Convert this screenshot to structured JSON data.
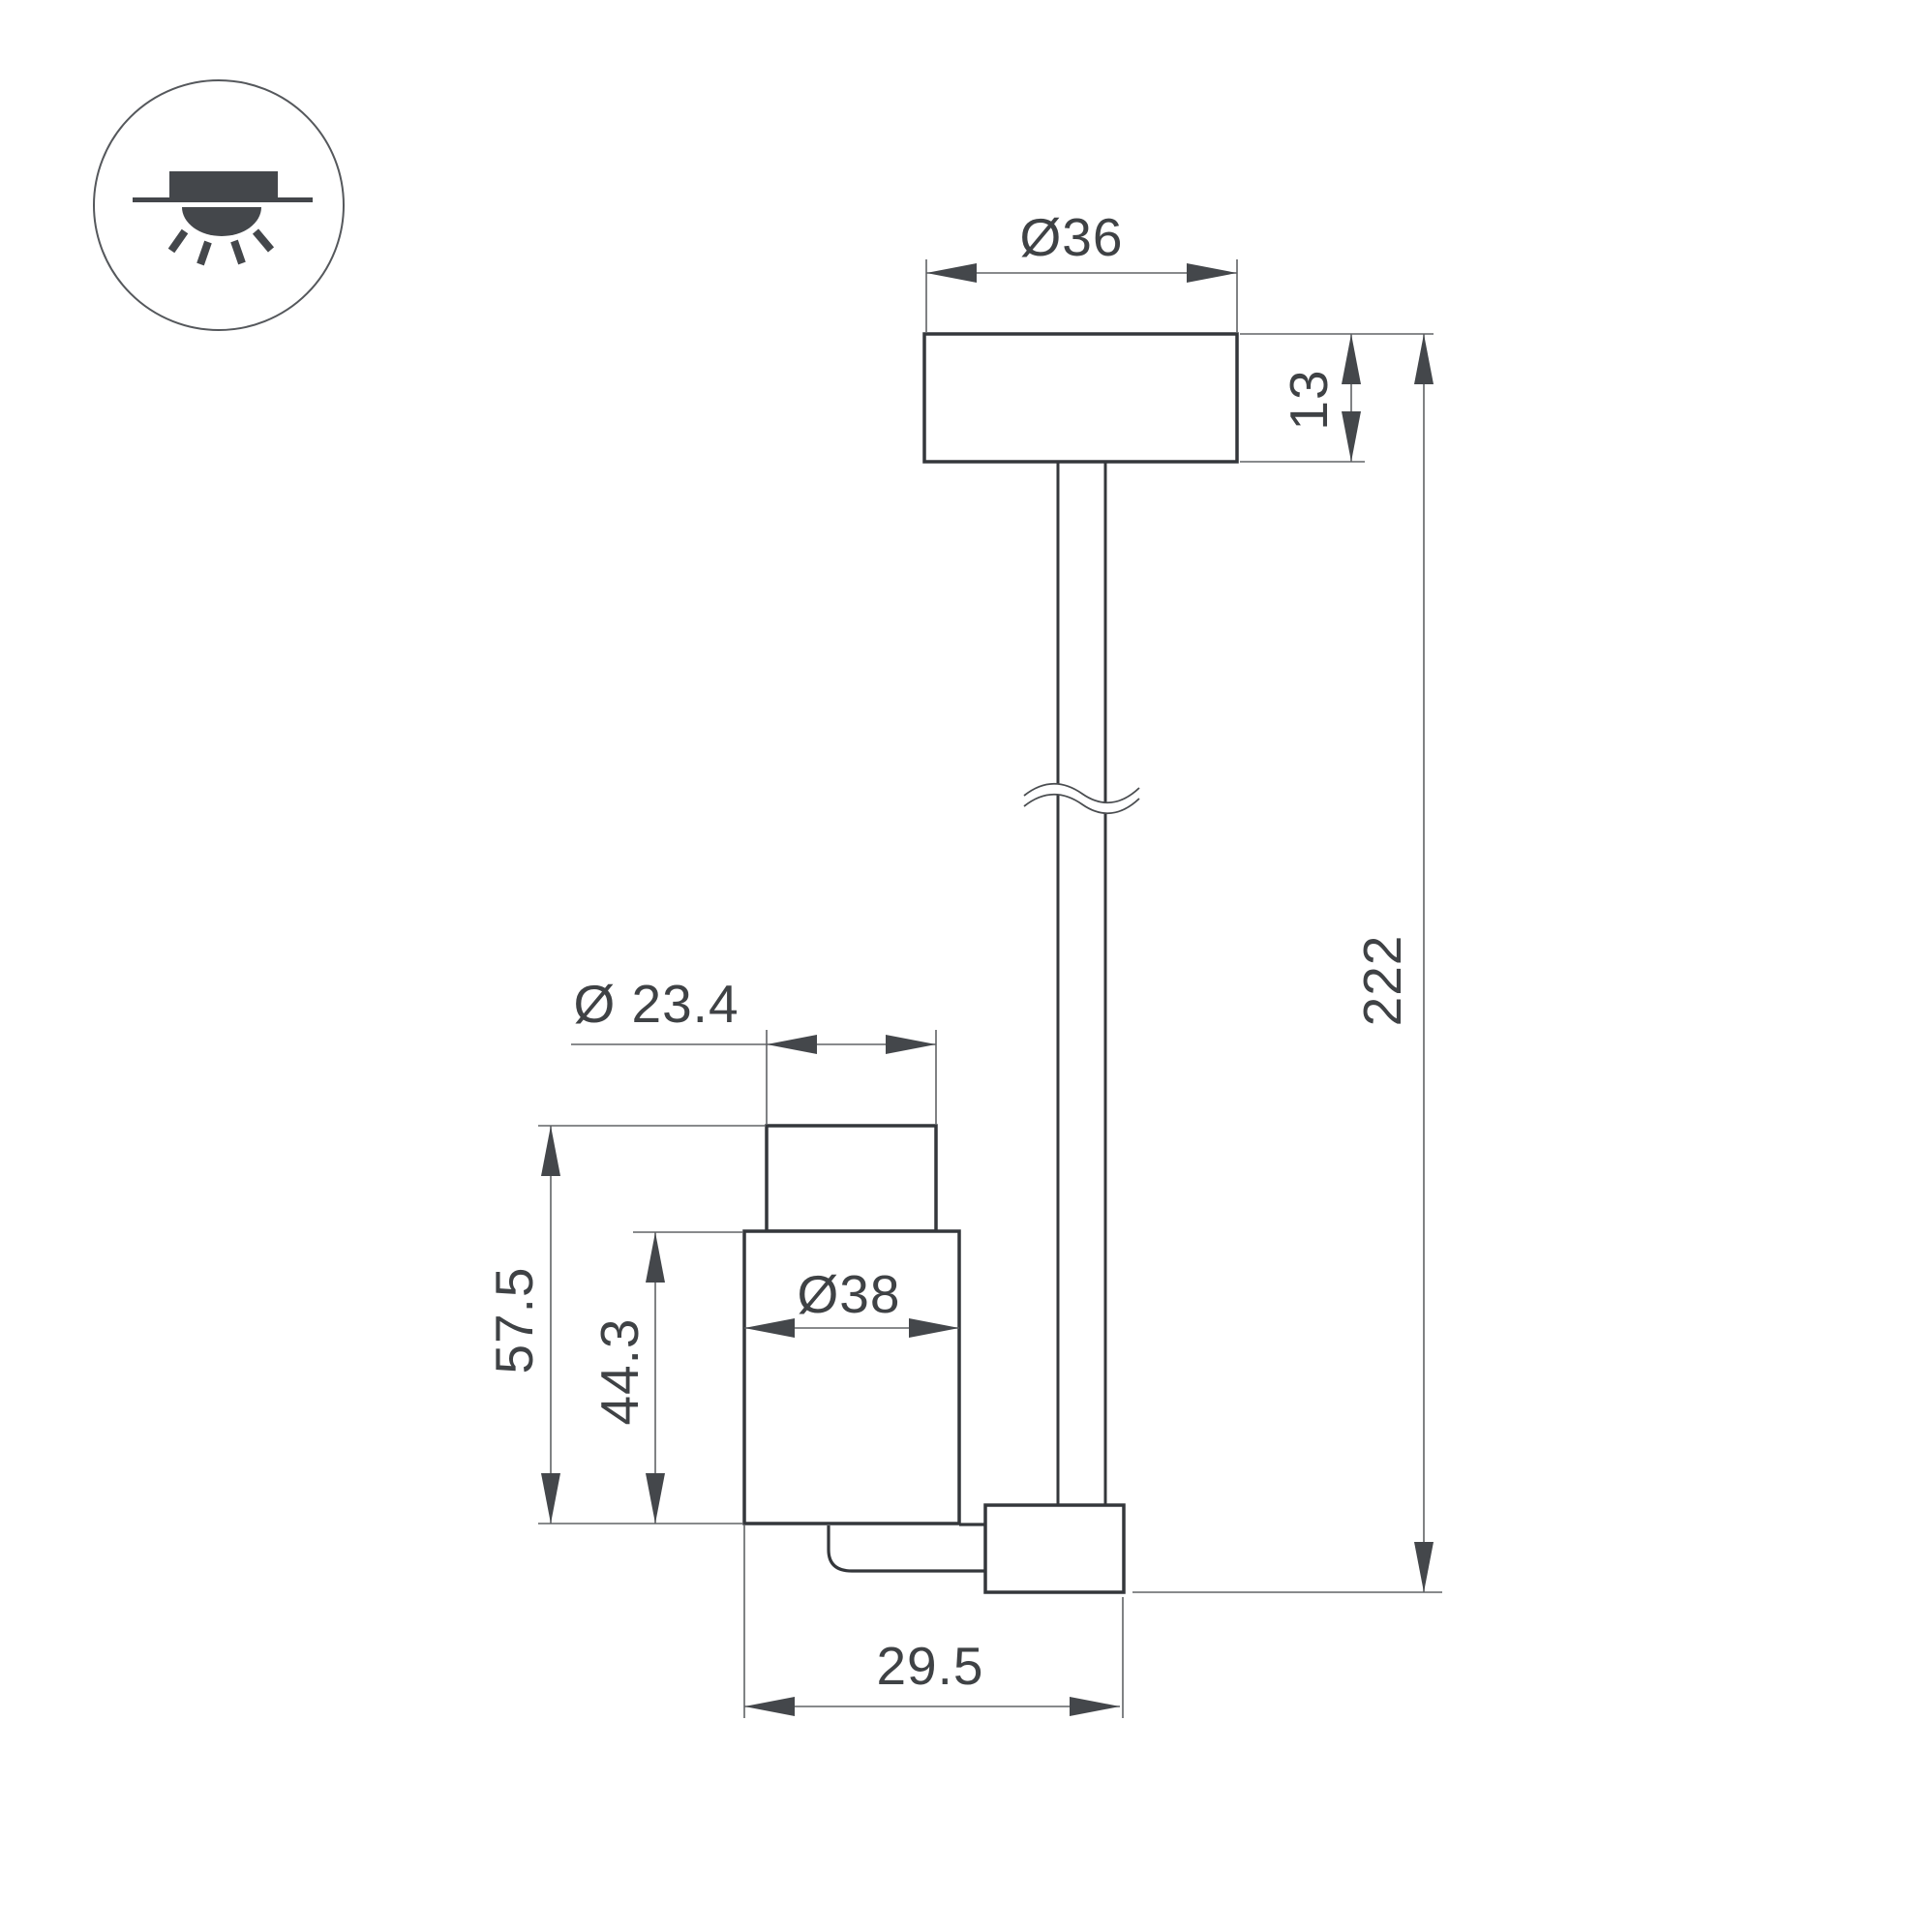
{
  "drawing": {
    "type": "technical-dimension-drawing",
    "subject": "surface-mounted ceiling spot luminaire, side view",
    "colors": {
      "outline": "#34373b",
      "dimension_line": "#606366",
      "text": "#3f4245",
      "arrow_fill": "#44474b",
      "background": "#ffffff"
    },
    "icon": {
      "name": "surface-ceiling-downlight-icon",
      "meaning": "surface mount luminaire shining downward"
    },
    "dimensions": {
      "canopy_diameter": "Ø36",
      "canopy_height": "13",
      "overall_height": "222",
      "head_top_diameter": "Ø 23.4",
      "head_total_height": "57.5",
      "head_body_height": "44.3",
      "head_body_diameter": "Ø38",
      "head_depth": "29.5"
    }
  }
}
